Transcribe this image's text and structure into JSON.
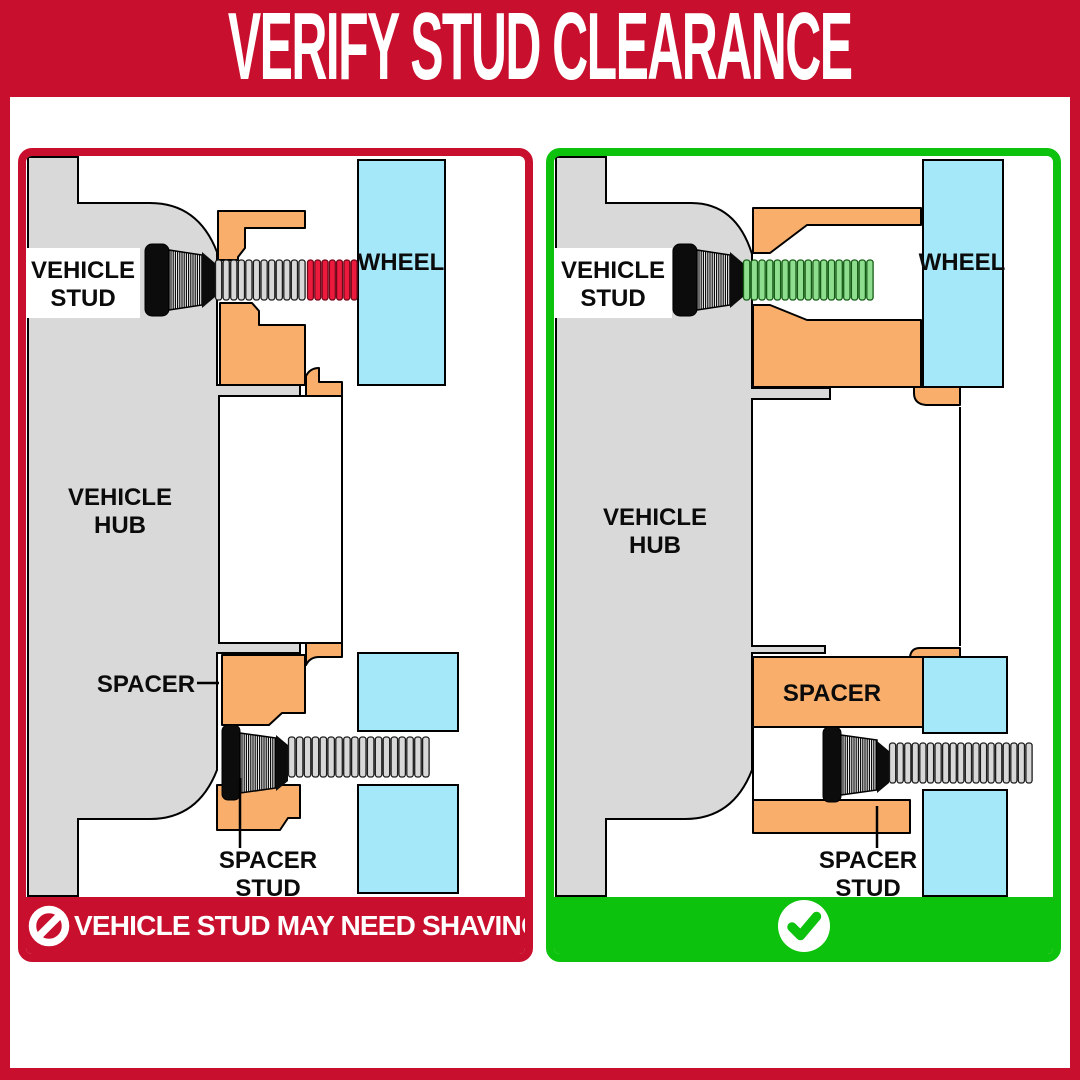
{
  "header": {
    "title": "VERIFY STUD CLEARANCE"
  },
  "colors": {
    "brand_red": "#C8102E",
    "bright_green": "#0CC20C",
    "hub_gray": "#D9D9D9",
    "spacer_orange": "#F9AF6B",
    "wheel_blue": "#A5E8FA",
    "thread_gray": "#D8D8D8",
    "thread_red": "#EC1A3C",
    "thread_green": "#8FDE8F"
  },
  "left_panel": {
    "verdict": "incorrect",
    "labels": {
      "vehicle_stud": [
        "VEHICLE",
        "STUD"
      ],
      "wheel": "WHEEL",
      "vehicle_hub": [
        "VEHICLE",
        "HUB"
      ],
      "spacer": "SPACER",
      "spacer_stud": [
        "SPACER",
        "STUD"
      ]
    },
    "banner": {
      "icon": "no-symbol",
      "text": "VEHICLE STUD MAY NEED SHAVING"
    }
  },
  "right_panel": {
    "verdict": "correct",
    "labels": {
      "vehicle_stud": [
        "VEHICLE",
        "STUD"
      ],
      "wheel": "WHEEL",
      "vehicle_hub": [
        "VEHICLE",
        "HUB"
      ],
      "spacer": "SPACER",
      "spacer_stud": [
        "SPACER",
        "STUD"
      ]
    },
    "banner": {
      "icon": "check",
      "text": ""
    }
  }
}
